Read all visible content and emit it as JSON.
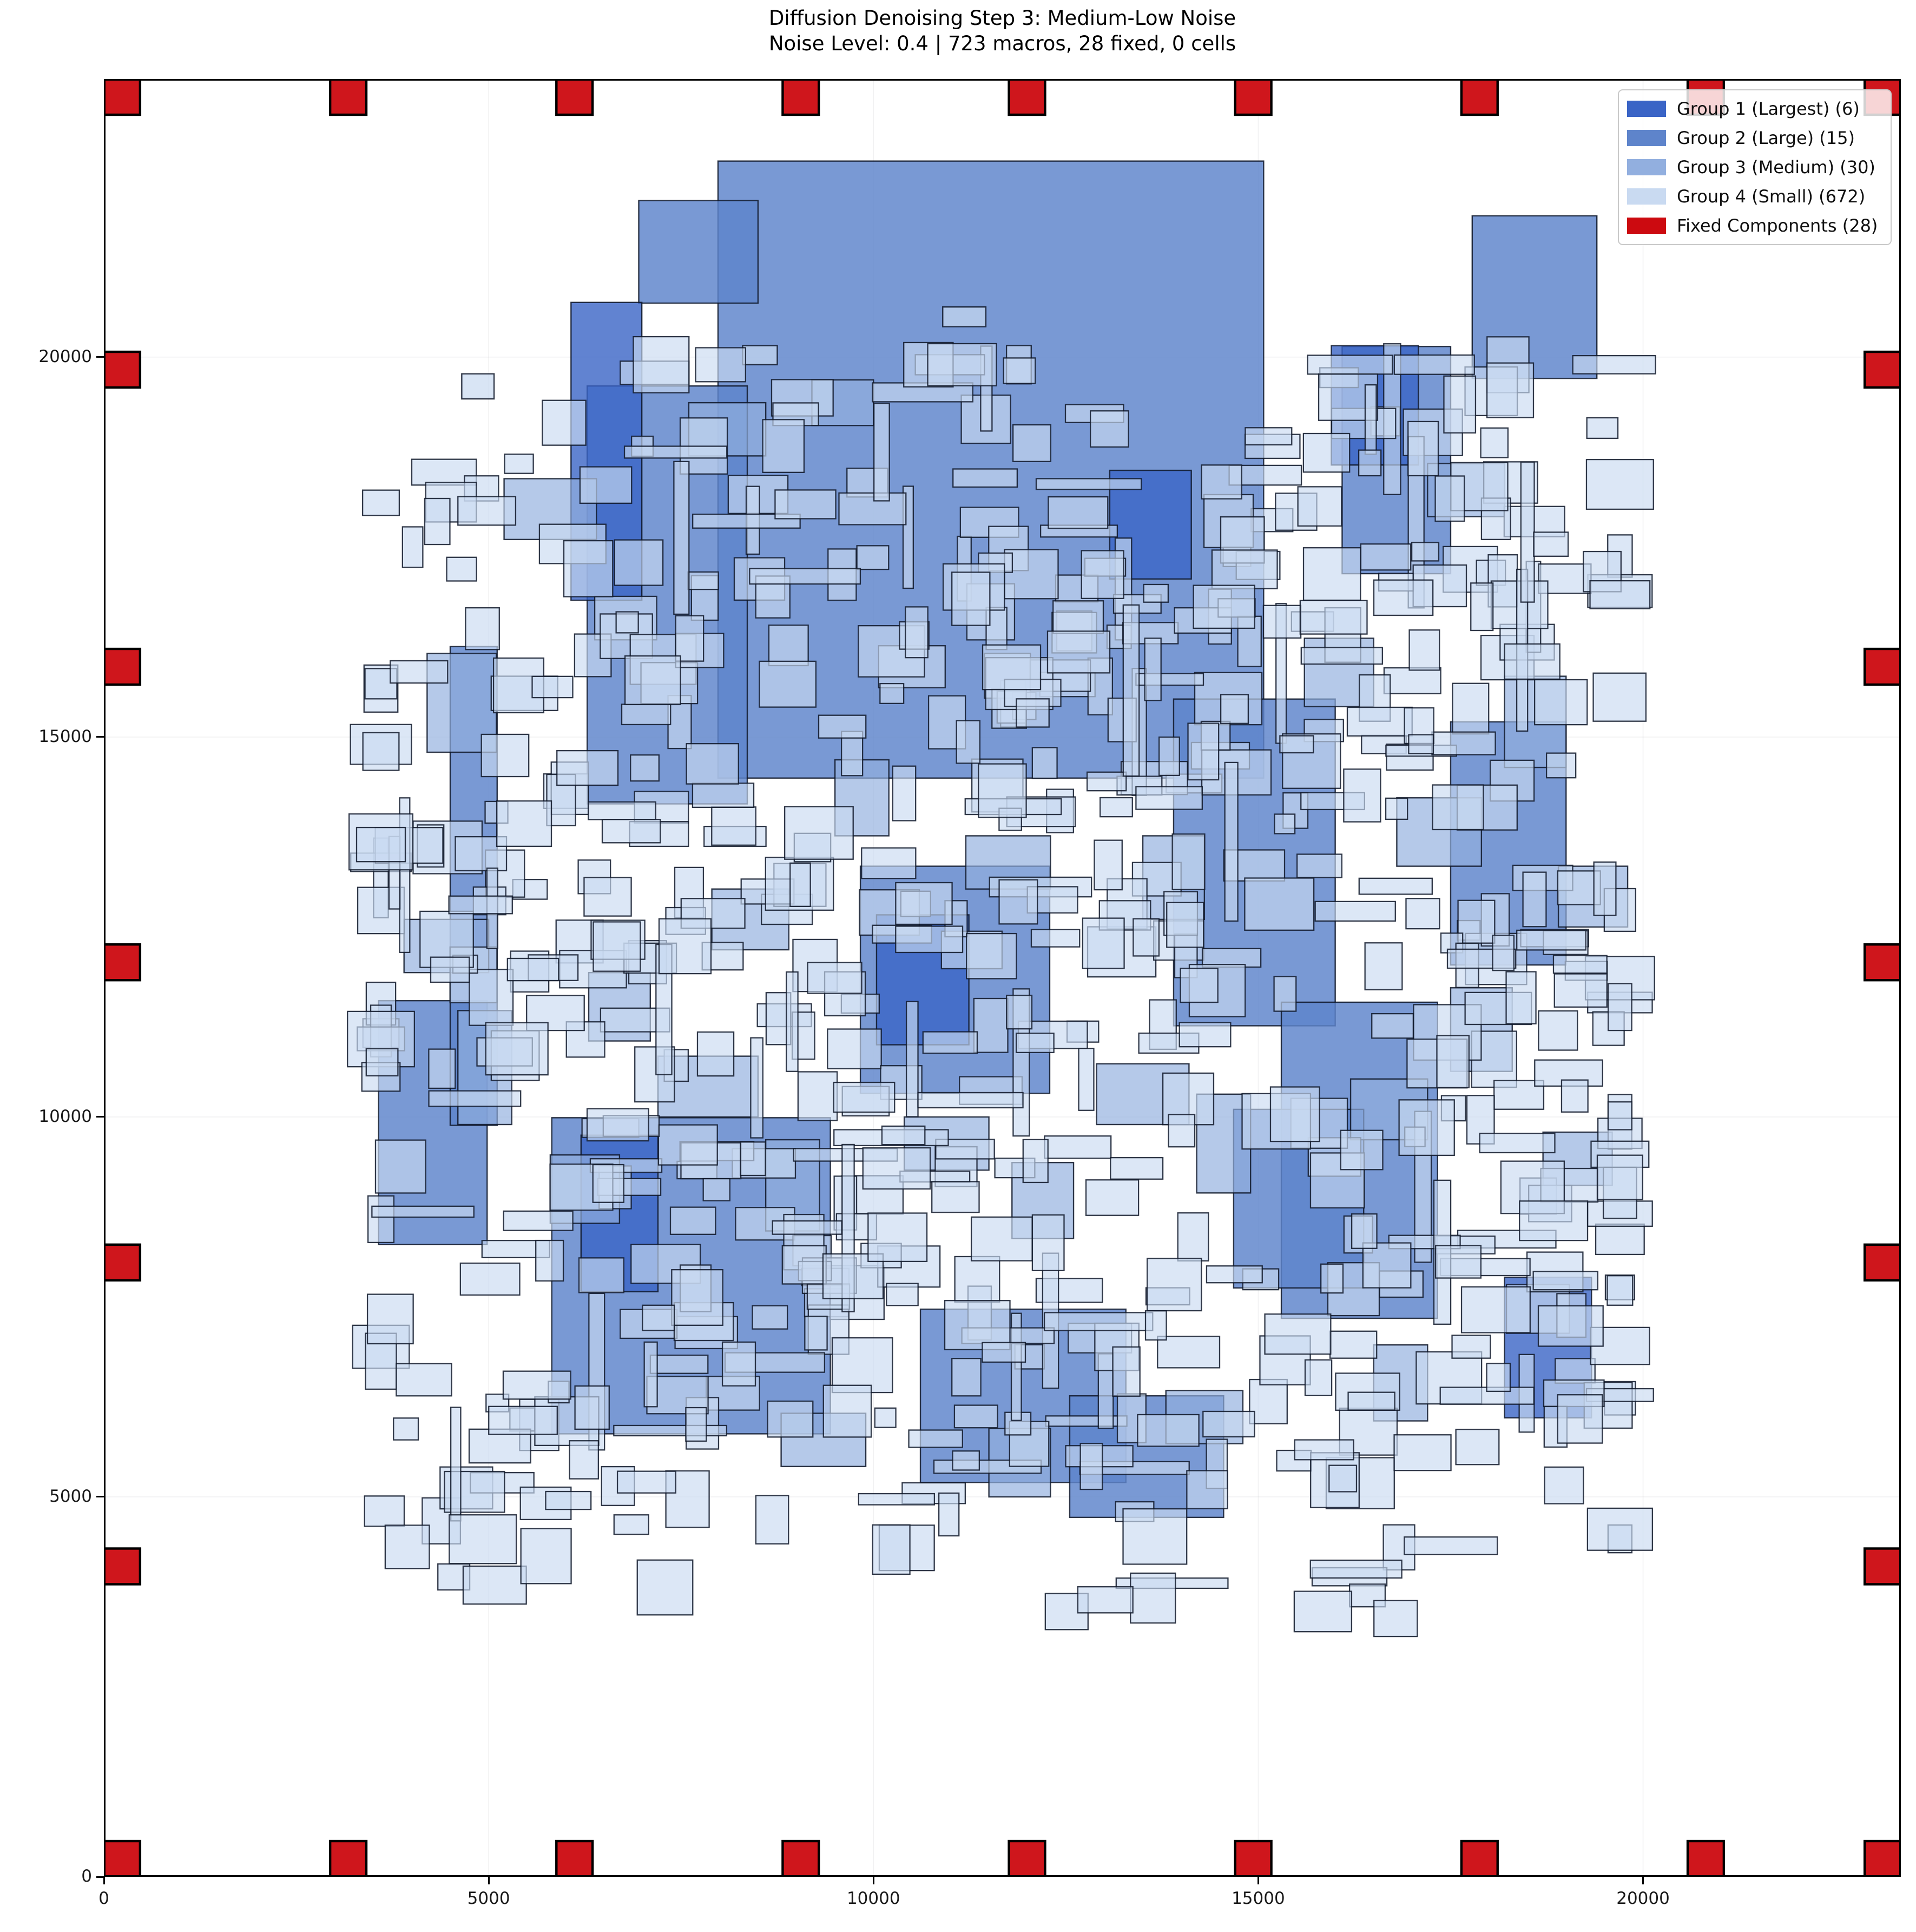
{
  "title": {
    "line1": "Diffusion Denoising Step 3: Medium-Low Noise",
    "line2": "Noise Level: 0.4 | 723 macros, 28 fixed, 0 cells"
  },
  "legend": {
    "entries": [
      {
        "label": "Group 1 (Largest) (6)",
        "color": "#3a64c6"
      },
      {
        "label": "Group 2 (Large) (15)",
        "color": "#5e84cb"
      },
      {
        "label": "Group 3 (Medium) (30)",
        "color": "#92afdf"
      },
      {
        "label": "Group 4 (Small) (672)",
        "color": "#c9daf1"
      },
      {
        "label": "Fixed Components (28)",
        "color": "#cc0a10"
      }
    ]
  },
  "chart_data": {
    "type": "floorplan_rectangle_placement",
    "title": "Diffusion Denoising Step 3: Medium-Low Noise",
    "subtitle": "Noise Level: 0.4 | 723 macros, 28 fixed, 0 cells",
    "noise_level": 0.4,
    "macro_count": 723,
    "fixed_count": 28,
    "cell_count": 0,
    "axes": {
      "x_min": 0,
      "x_max": 23350,
      "y_min": 0,
      "y_max": 23660,
      "x_ticks": [
        0,
        5000,
        10000,
        15000,
        20000
      ],
      "y_ticks": [
        0,
        5000,
        10000,
        15000,
        20000
      ],
      "grid": true,
      "grid_color": "#b0b0b8",
      "grid_alpha": 0.18
    },
    "style": {
      "edge_color": "#0e1628",
      "edge_alpha": 0.85,
      "fill_alpha": 0.8,
      "fixed_fill_alpha": 0.95
    },
    "groups": [
      {
        "name": "Group 1 (Largest)",
        "count": 6,
        "color": "#3a64c6",
        "rects": [
          [
            6070,
            16800,
            920,
            3920
          ],
          [
            15950,
            18580,
            1130,
            1570
          ],
          [
            10040,
            10950,
            1200,
            1710
          ],
          [
            6200,
            7700,
            1000,
            2060
          ],
          [
            18200,
            6040,
            1130,
            1850
          ],
          [
            13070,
            17080,
            1060,
            1430
          ]
        ]
      },
      {
        "name": "Group 2 (Large)",
        "count": 15,
        "color": "#5e84cb",
        "rects": [
          [
            7980,
            14460,
            7090,
            8120
          ],
          [
            6280,
            14120,
            2080,
            5500
          ],
          [
            4500,
            9890,
            610,
            6300
          ],
          [
            13900,
            11200,
            2100,
            4300
          ],
          [
            16090,
            17150,
            1410,
            2990
          ],
          [
            5820,
            5830,
            3620,
            4160
          ],
          [
            9830,
            10310,
            2460,
            2990
          ],
          [
            10610,
            5190,
            2670,
            2280
          ],
          [
            12550,
            4730,
            2000,
            1600
          ],
          [
            15300,
            7350,
            2030,
            4160
          ],
          [
            3570,
            8320,
            1410,
            3210
          ],
          [
            17780,
            19720,
            1620,
            2140
          ],
          [
            6950,
            20710,
            1550,
            1350
          ],
          [
            14680,
            7750,
            1690,
            2350
          ],
          [
            17500,
            12000,
            1500,
            3200
          ]
        ]
      },
      {
        "name": "Group 3 (Medium)",
        "count": 30,
        "color": "#92afdf",
        "rects": [
          [
            4200,
            14800,
            900,
            1300
          ],
          [
            5200,
            17600,
            1200,
            800
          ],
          [
            7600,
            18700,
            1000,
            700
          ],
          [
            9200,
            19100,
            800,
            600
          ],
          [
            4600,
            9900,
            700,
            1500
          ],
          [
            3900,
            11900,
            1100,
            700
          ],
          [
            5800,
            8600,
            900,
            900
          ],
          [
            7200,
            10000,
            1300,
            800
          ],
          [
            8600,
            8500,
            700,
            1200
          ],
          [
            10400,
            9300,
            1100,
            700
          ],
          [
            11800,
            8400,
            800,
            1000
          ],
          [
            12900,
            9900,
            1200,
            800
          ],
          [
            14200,
            9000,
            700,
            1300
          ],
          [
            16200,
            9700,
            1000,
            800
          ],
          [
            17500,
            10600,
            800,
            1100
          ],
          [
            18700,
            9100,
            900,
            700
          ],
          [
            16800,
            13300,
            1100,
            900
          ],
          [
            18200,
            14600,
            800,
            1200
          ],
          [
            17200,
            17900,
            1000,
            700
          ],
          [
            15600,
            15400,
            900,
            900
          ],
          [
            13500,
            12600,
            800,
            1100
          ],
          [
            11200,
            13000,
            1100,
            700
          ],
          [
            9500,
            13700,
            700,
            1000
          ],
          [
            7900,
            12200,
            1000,
            800
          ],
          [
            6300,
            11000,
            800,
            900
          ],
          [
            8800,
            5400,
            1100,
            700
          ],
          [
            11500,
            5000,
            800,
            900
          ],
          [
            13800,
            5700,
            1000,
            700
          ],
          [
            16500,
            6000,
            700,
            1000
          ],
          [
            18900,
            12500,
            900,
            800
          ]
        ]
      },
      {
        "name": "Group 4 (Small)",
        "count": 672,
        "color": "#c9daf1",
        "extra_rects": [
          [
            10900,
            20400,
            560,
            260
          ],
          [
            4650,
            19450,
            420,
            330
          ],
          [
            15800,
            19600,
            500,
            260
          ],
          [
            8300,
            19900,
            450,
            250
          ]
        ],
        "procedural": {
          "seed": 42,
          "count": 668,
          "bounds": [
            3600,
            3400,
            19700,
            19900
          ],
          "cluster_sigma": 1500,
          "uniform_fraction": 0.12,
          "cluster_centers": [
            [
              5500,
              17200
            ],
            [
              8500,
              17800
            ],
            [
              12500,
              17500
            ],
            [
              16500,
              16800
            ],
            [
              18300,
              17600
            ],
            [
              4800,
              12500
            ],
            [
              7500,
              13500
            ],
            [
              11000,
              12000
            ],
            [
              14500,
              13000
            ],
            [
              18000,
              12000
            ],
            [
              5500,
              6500
            ],
            [
              8000,
              7500
            ],
            [
              11500,
              6500
            ],
            [
              14500,
              6200
            ],
            [
              17500,
              7000
            ],
            [
              18800,
              9500
            ],
            [
              9800,
              9800
            ],
            [
              12800,
              15500
            ]
          ],
          "size_w": [
            260,
            900
          ],
          "size_h": [
            220,
            750
          ],
          "tall_fraction": 0.07,
          "tall_w": [
            120,
            220
          ],
          "tall_h": [
            800,
            2400
          ],
          "wide_fraction": 0.06,
          "wide_w": [
            850,
            1500
          ],
          "wide_h": [
            130,
            260
          ]
        }
      }
    ],
    "fixed_components": {
      "color": "#cc0a10",
      "edge_color": "#000000",
      "size": 470,
      "bottom_row_y": 0,
      "top_row_y": 23190,
      "row_xs": [
        0,
        2940,
        5880,
        8820,
        11760,
        14700,
        17640,
        20580,
        22880
      ],
      "left_col_x": 0,
      "right_col_x": 22880,
      "col_ys": [
        19600,
        15690,
        11800,
        7850,
        3850
      ]
    }
  }
}
